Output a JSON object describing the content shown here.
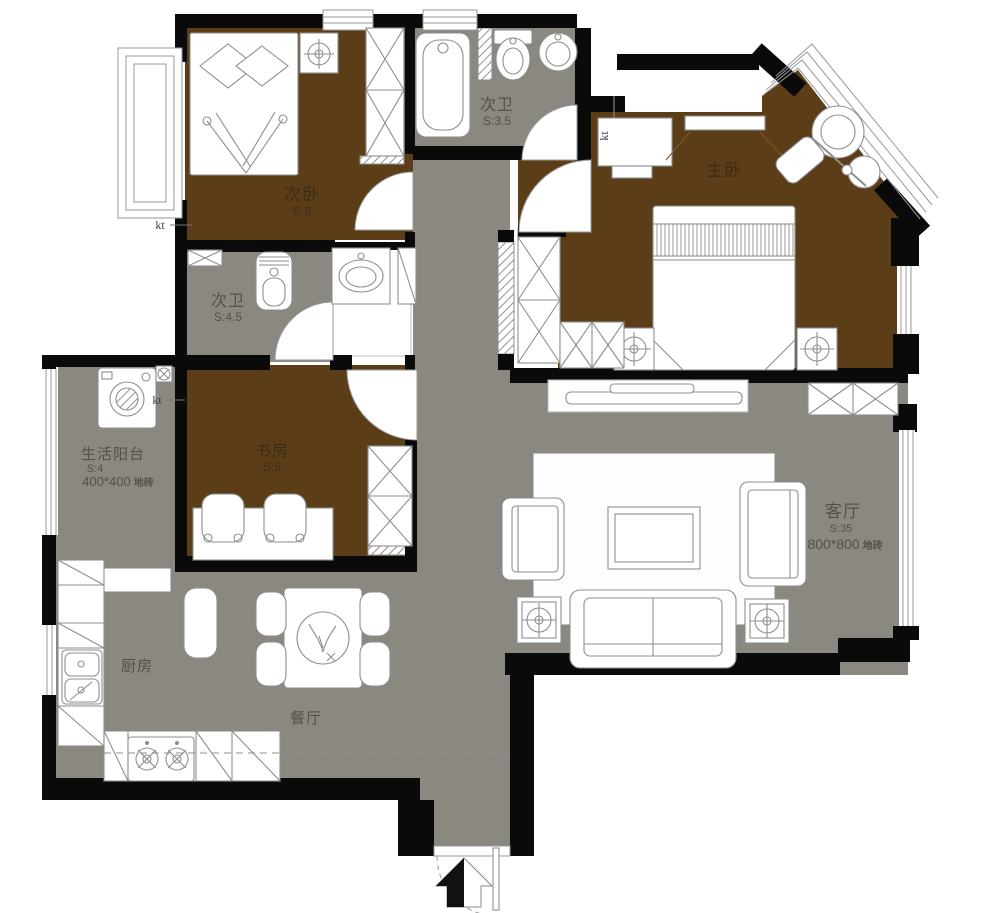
{
  "plan_type": "apartment floor plan",
  "colors": {
    "wood_floor": "#5b3d18",
    "tile_floor": "#8b8781",
    "wall": "#0a0a0a",
    "furniture_line": "#8e8e8e",
    "label_on_tile": "#565147",
    "label_on_wood": "#3c2d17"
  },
  "rooms": [
    {
      "name": "次卧",
      "area": "S:8"
    },
    {
      "name": "次卫",
      "area": "S:3.5"
    },
    {
      "name": "主卧"
    },
    {
      "name": "次卫",
      "area": "S:4.5"
    },
    {
      "name": "生活阳台",
      "area": "S:4",
      "finish": "400*400",
      "material": "地砖"
    },
    {
      "name": "书房",
      "area": "S:8"
    },
    {
      "name": "客厅",
      "area": "S:35",
      "finish": "800*800",
      "material": "地砖"
    },
    {
      "name": "厨房"
    },
    {
      "name": "餐厅"
    }
  ],
  "annotations": {
    "ac_unit": "kt"
  }
}
